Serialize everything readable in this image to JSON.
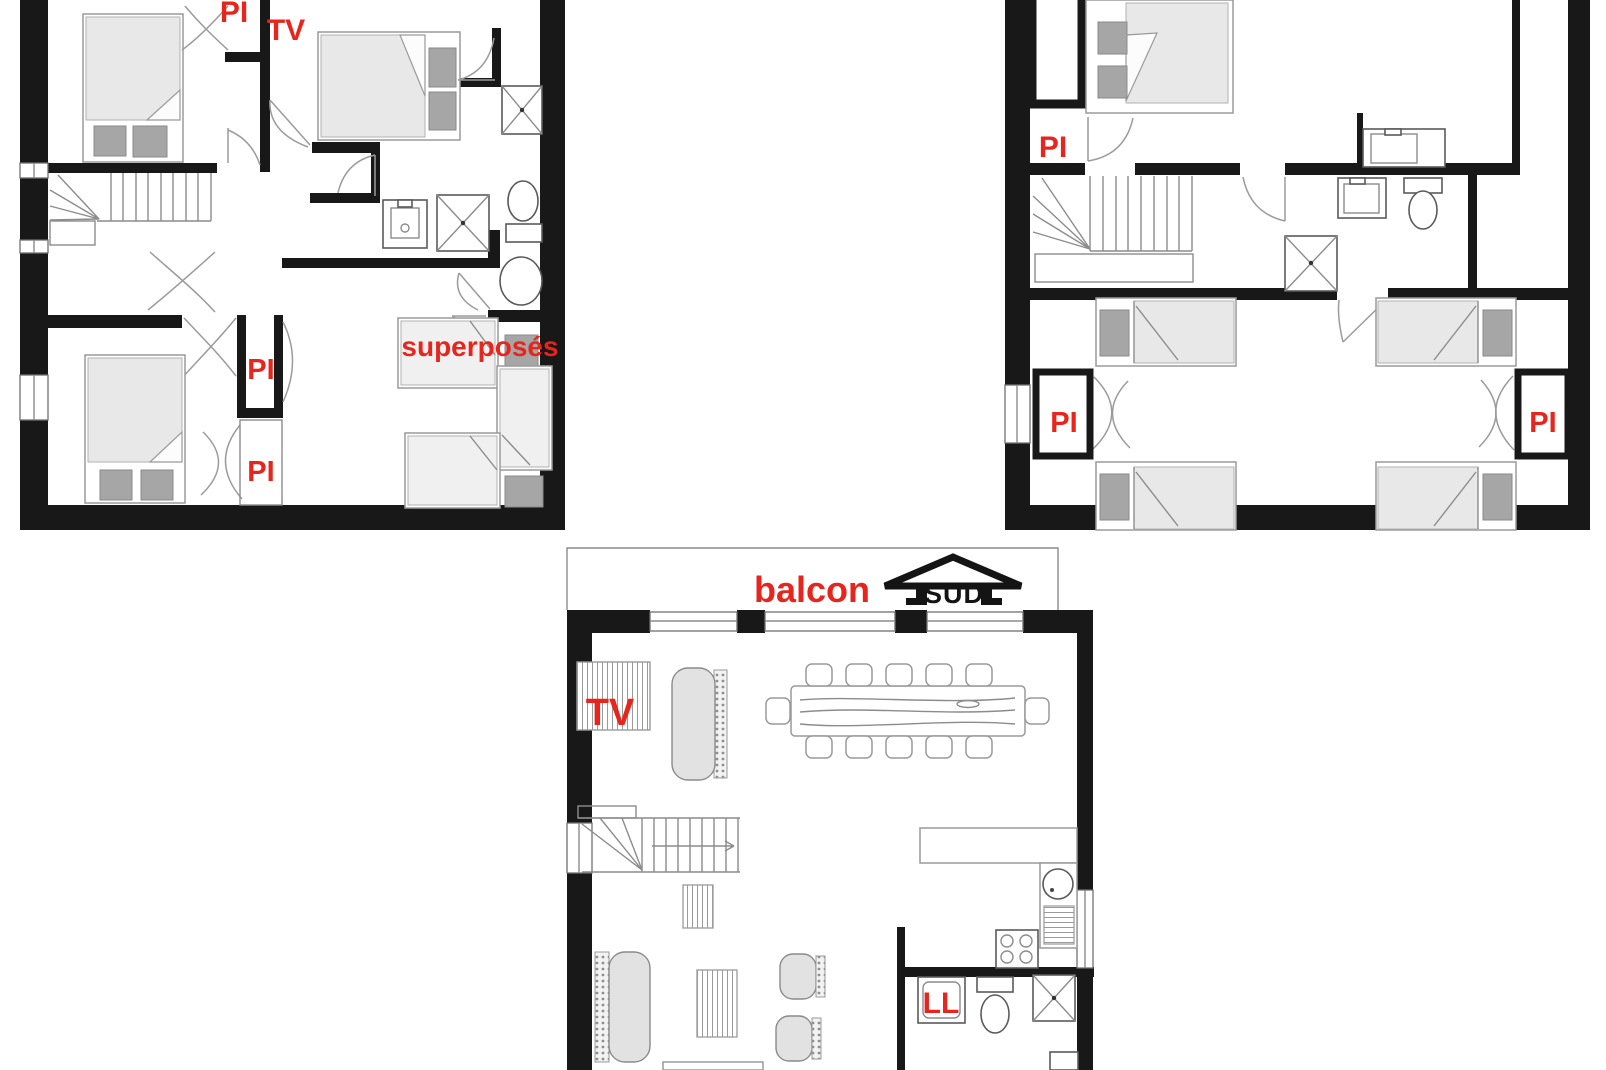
{
  "labels": {
    "left_unit": {
      "pi_top": "PI",
      "tv_bedroom": "TV",
      "pi_closet_upper": "PI",
      "pi_closet_lower": "PI",
      "bunk_room": "superposés"
    },
    "right_unit": {
      "pi_top": "PI",
      "pi_bottom_left": "PI",
      "pi_bottom_right": "PI"
    },
    "ground_floor": {
      "balcony": "balcon",
      "compass": "SUD",
      "tv": "TV",
      "washer": "LL"
    }
  },
  "colors": {
    "label_red": "#e8251d",
    "wall": "#181818",
    "furniture_fill": "#e8e8e8",
    "nightstand": "#a6a6a6",
    "compass_black": "#141414"
  }
}
